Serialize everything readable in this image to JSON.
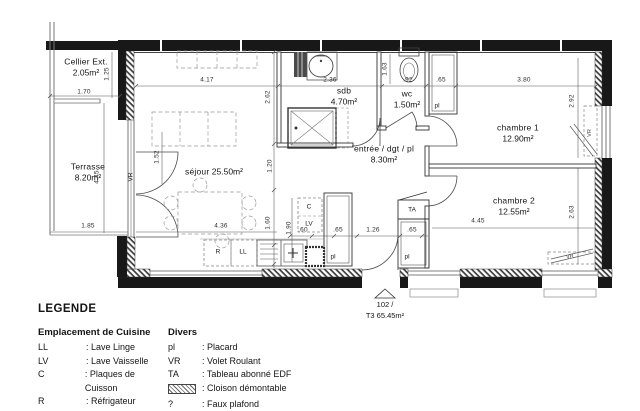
{
  "plan": {
    "rooms": [
      {
        "name": "Cellier Ext.",
        "area": "2.05m²"
      },
      {
        "name": "Terrasse",
        "area": "8.20m²"
      },
      {
        "name": "séjour",
        "area": "25.50m²"
      },
      {
        "name": "sdb",
        "area": "4.70m²"
      },
      {
        "name": "wc",
        "area": "1.50m²"
      },
      {
        "name": "entrée / dgt / pl",
        "area": "8.30m²"
      },
      {
        "name": "chambre 1",
        "area": "12.90m²"
      },
      {
        "name": "chambre 2",
        "area": "12.55m²"
      }
    ],
    "unit": {
      "number": "102 /",
      "label": "T3 65.45m²"
    },
    "dims": [
      "1.70",
      "1.25",
      "4.17",
      "2.36",
      "1.63",
      ".92",
      ".65",
      "3.80",
      "2.92",
      "2.62",
      "1.52",
      "4.45",
      "1.20",
      "1.60",
      "1.90",
      "1.85",
      "4.36",
      ".60",
      ".65",
      "1.26",
      ".65",
      "4.45",
      "2.63"
    ],
    "tags": {
      "vr": "VR",
      "pl": "pl",
      "ta": "TA",
      "c": "C",
      "lv": "LV",
      "r": "R",
      "ll": "LL"
    }
  },
  "legend": {
    "title": "LEGENDE",
    "kitchen": {
      "title": "Emplacement de Cuisine",
      "items": [
        {
          "abbr": "LL",
          "label": ": Lave Linge"
        },
        {
          "abbr": "LV",
          "label": ": Lave Vaisselle"
        },
        {
          "abbr": "C",
          "label": ": Plaques de Cuisson"
        },
        {
          "abbr": "R",
          "label": ": Réfrigateur"
        }
      ]
    },
    "divers": {
      "title": "Divers",
      "items": [
        {
          "abbr": "pl",
          "label": ": Placard"
        },
        {
          "abbr": "VR",
          "label": ": Volet Roulant"
        },
        {
          "abbr": "TA",
          "label": ": Tableau abonné EDF"
        },
        {
          "abbr": "",
          "label": ": Cloison démontable"
        },
        {
          "abbr": "?",
          "label": ": Faux plafond"
        }
      ]
    }
  }
}
